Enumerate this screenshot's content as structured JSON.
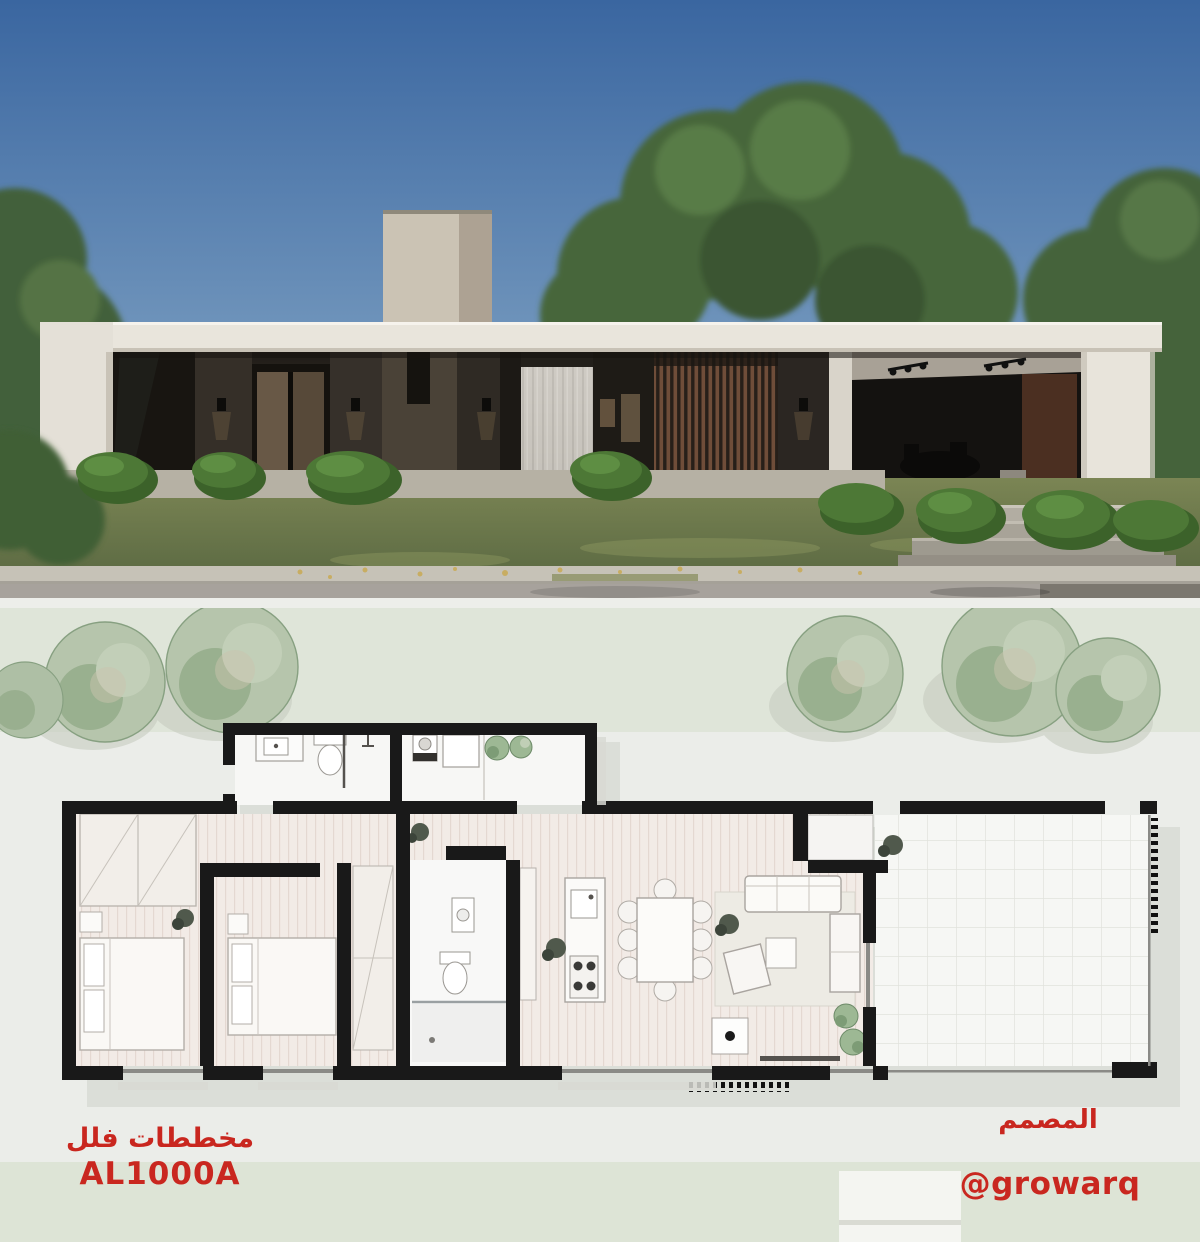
{
  "branding": {
    "plans_label": "مخططات فلل",
    "plan_code": "AL1000A",
    "designer_label": "المصمم",
    "designer_handle": "@growarq"
  },
  "colors": {
    "accent_red": "#c9271f",
    "sky_top": "#3a66a0",
    "sky_horizon": "#cdd9de",
    "foliage_green": "#47663a",
    "house_fascia": "#e9e5dc",
    "facade_dark": "#332e28",
    "site_band_green": "#dfe5d9",
    "plan_tree_green": "#b6c5ac",
    "plan_wall_black": "#191919",
    "wood_floor": "#f2ebe6",
    "terrace_tile": "#f6f7f4"
  }
}
